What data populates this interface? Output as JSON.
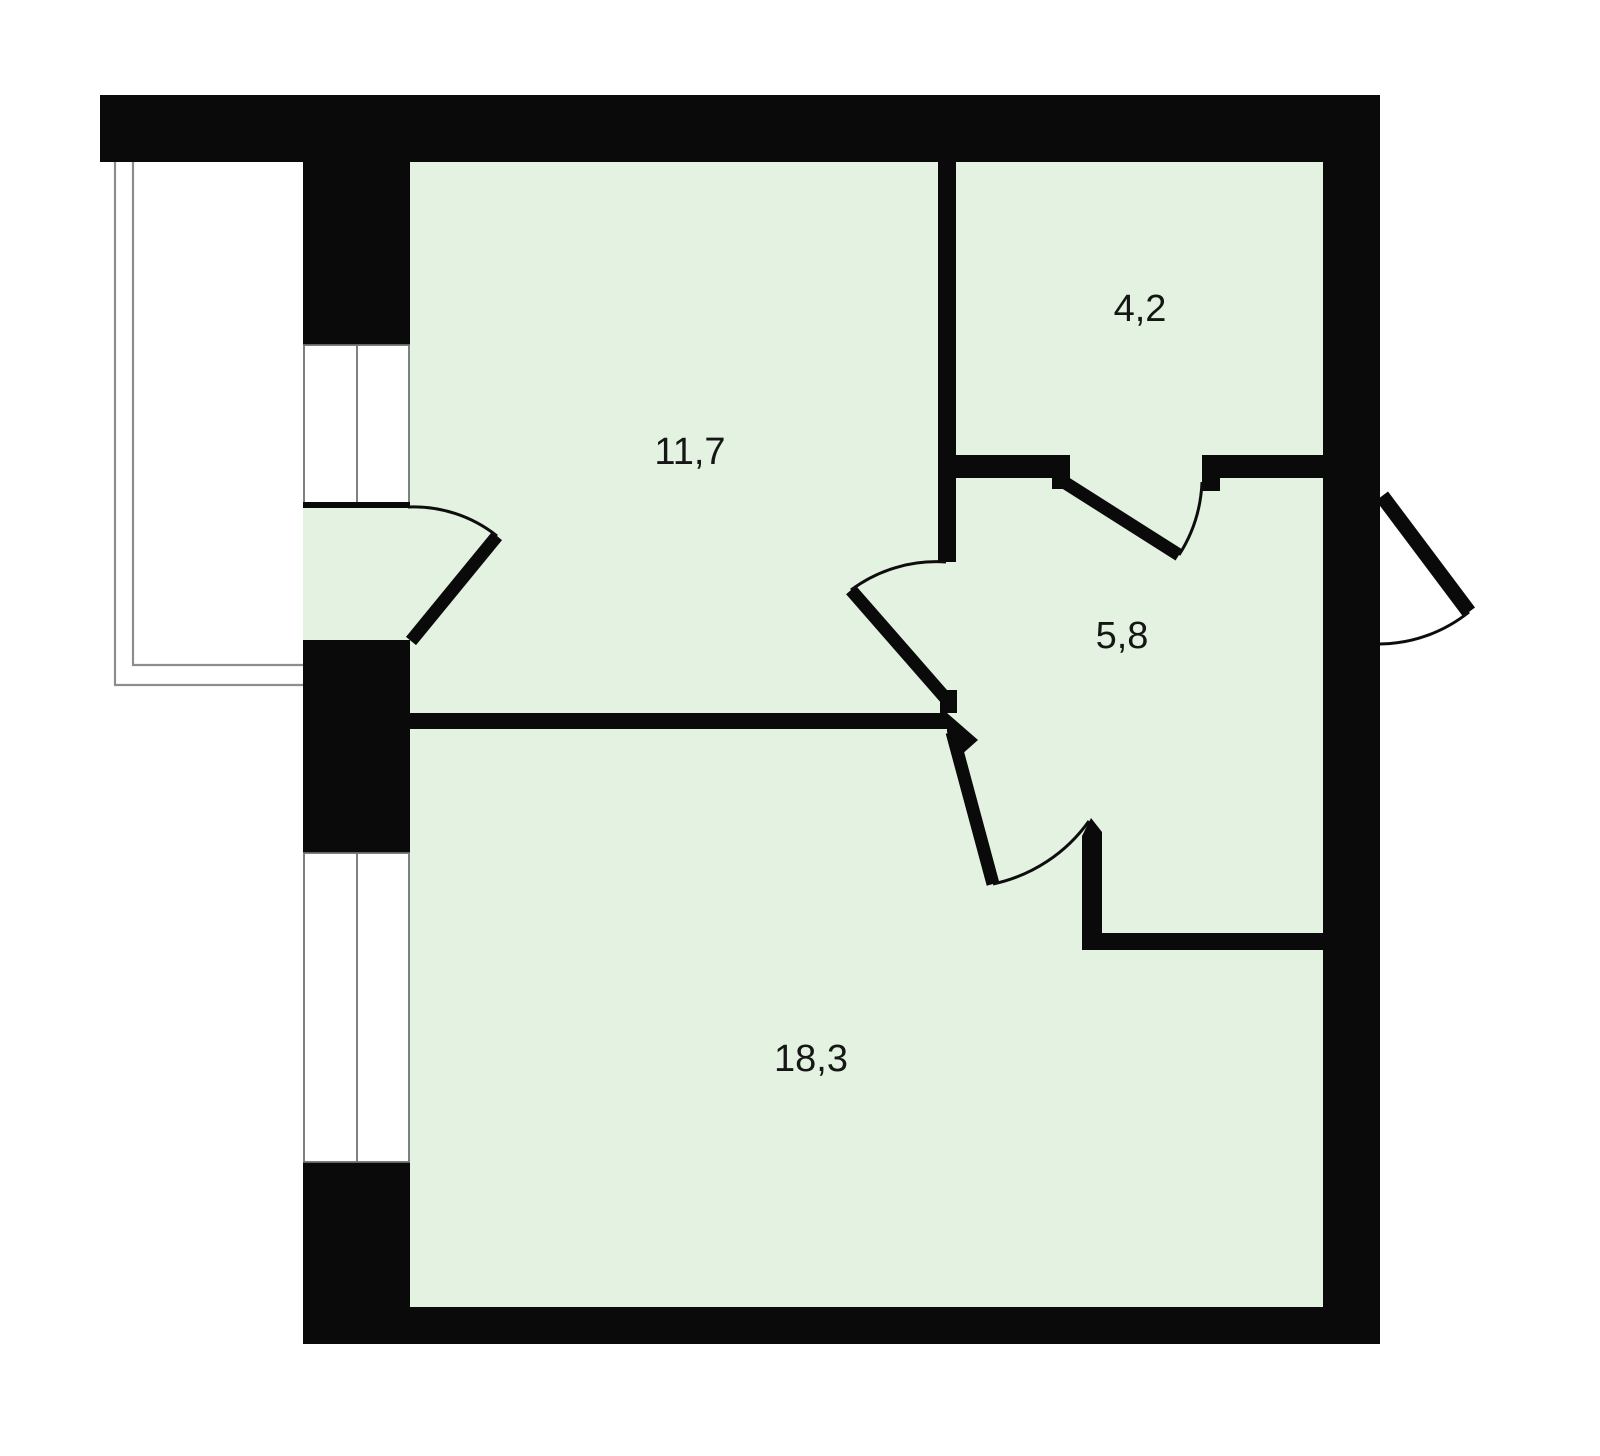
{
  "plan": {
    "type": "apartment-floor-plan",
    "colors": {
      "background": "#ffffff",
      "walls": "#0a0a0a",
      "room_fill": "#e4f3e1",
      "thin_outline": "#8b8f8b",
      "label_text": "#161616"
    },
    "rooms": [
      {
        "id": "room-11-7",
        "label": "11,7"
      },
      {
        "id": "room-4-2",
        "label": "4,2"
      },
      {
        "id": "room-5-8",
        "label": "5,8"
      },
      {
        "id": "room-18-3",
        "label": "18,3"
      }
    ],
    "features": {
      "balcony": "open balcony outline at left drawn with double thin lines",
      "windows": 2,
      "doors": 5,
      "entry_door": "right side, swings outward"
    }
  }
}
